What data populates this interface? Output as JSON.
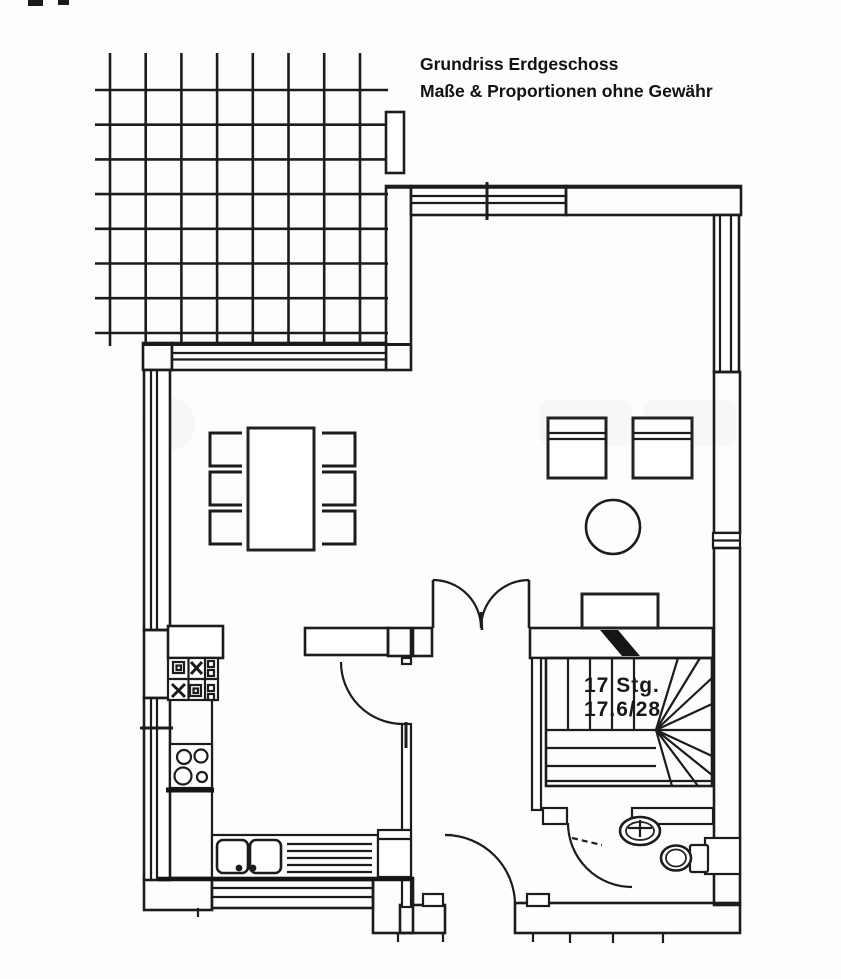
{
  "title": {
    "line1": "Grundriss Erdgeschoss",
    "line2": "Maße & Proportionen ohne Gewähr"
  },
  "stairs": {
    "count_label": "17 Stg.",
    "dimensions_label": "17.6/28"
  },
  "colors": {
    "ink": "#1c1c1c",
    "paper": "#fdfdfc",
    "chimney_fill": "#151515",
    "watermark": "#777777"
  }
}
